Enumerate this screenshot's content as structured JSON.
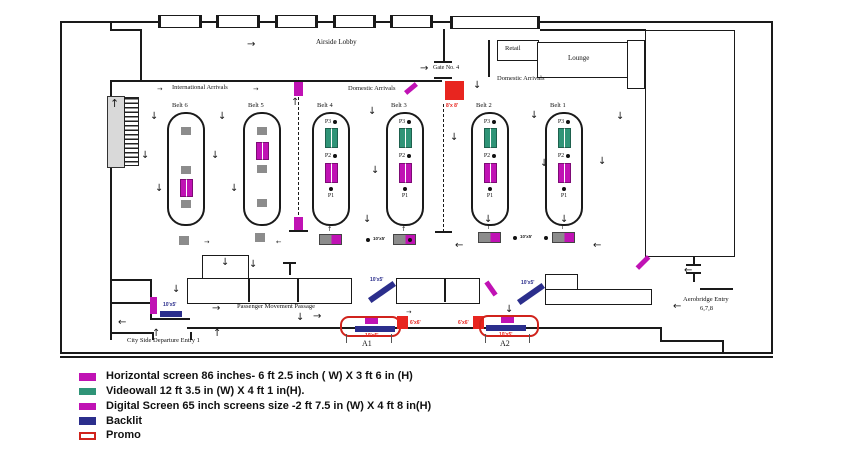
{
  "plan": {
    "labels": {
      "airside_lobby": "Airside Lobby",
      "international_arrivals": "International Arrivals",
      "domestic_arrivals_1": "Domestic Arrivals",
      "domestic_arrivals_2": "Domestic Arrivals",
      "gate_no_4": "Gate No. 4",
      "retail": "Retail",
      "lounge": "Lounge",
      "passenger_movement_passage": "Passenger Movement Passage",
      "city_side_departure_entry": "City Side Departure Entry 1",
      "aerobridge_entry_line1": "Aerobridge Entry",
      "aerobridge_entry_line2": "6,7,8",
      "zone_a1": "A1",
      "zone_a2": "A2"
    },
    "belts": [
      {
        "label": "Belt 6"
      },
      {
        "label": "Belt 5"
      },
      {
        "label": "Belt 4"
      },
      {
        "label": "Belt 3"
      },
      {
        "label": "Belt 2"
      },
      {
        "label": "Belt 1"
      }
    ],
    "position_labels": {
      "p1": "P1",
      "p2": "P2",
      "p3": "P3"
    },
    "sizes": {
      "s10x5": "10'x5'",
      "s6x6": "6'x6'",
      "s8x8": "8'x 8'"
    }
  },
  "legend": {
    "items": [
      {
        "label": "Horizontal screen 86 inches- 6 ft 2.5 inch ( W) X 3 ft 6 in (H)",
        "color": "#c012b4",
        "type": "horizontal-screen"
      },
      {
        "label": "Videowall 12 ft 3.5 in (W) X 4 ft 1 in(H).",
        "color": "#2f9477",
        "type": "videowall"
      },
      {
        "label": "Digital Screen 65 inch screens size -2 ft 7.5 in (W) X 4 ft 8 in(H)",
        "color": "#c012b4",
        "type": "digital-screen"
      },
      {
        "label": "Backlit",
        "color": "#2b2e8c",
        "type": "backlit"
      },
      {
        "label": "Promo",
        "color": "#ffffff",
        "border": "#d0231c",
        "type": "promo"
      }
    ]
  },
  "colors": {
    "screen": "#c012b4",
    "videowall": "#2f9477",
    "backlit": "#2b2e8c",
    "promo": "#d0231c",
    "red": "#e8251f",
    "gray": "#8c8c8c",
    "wall": "#1a1a1a"
  }
}
